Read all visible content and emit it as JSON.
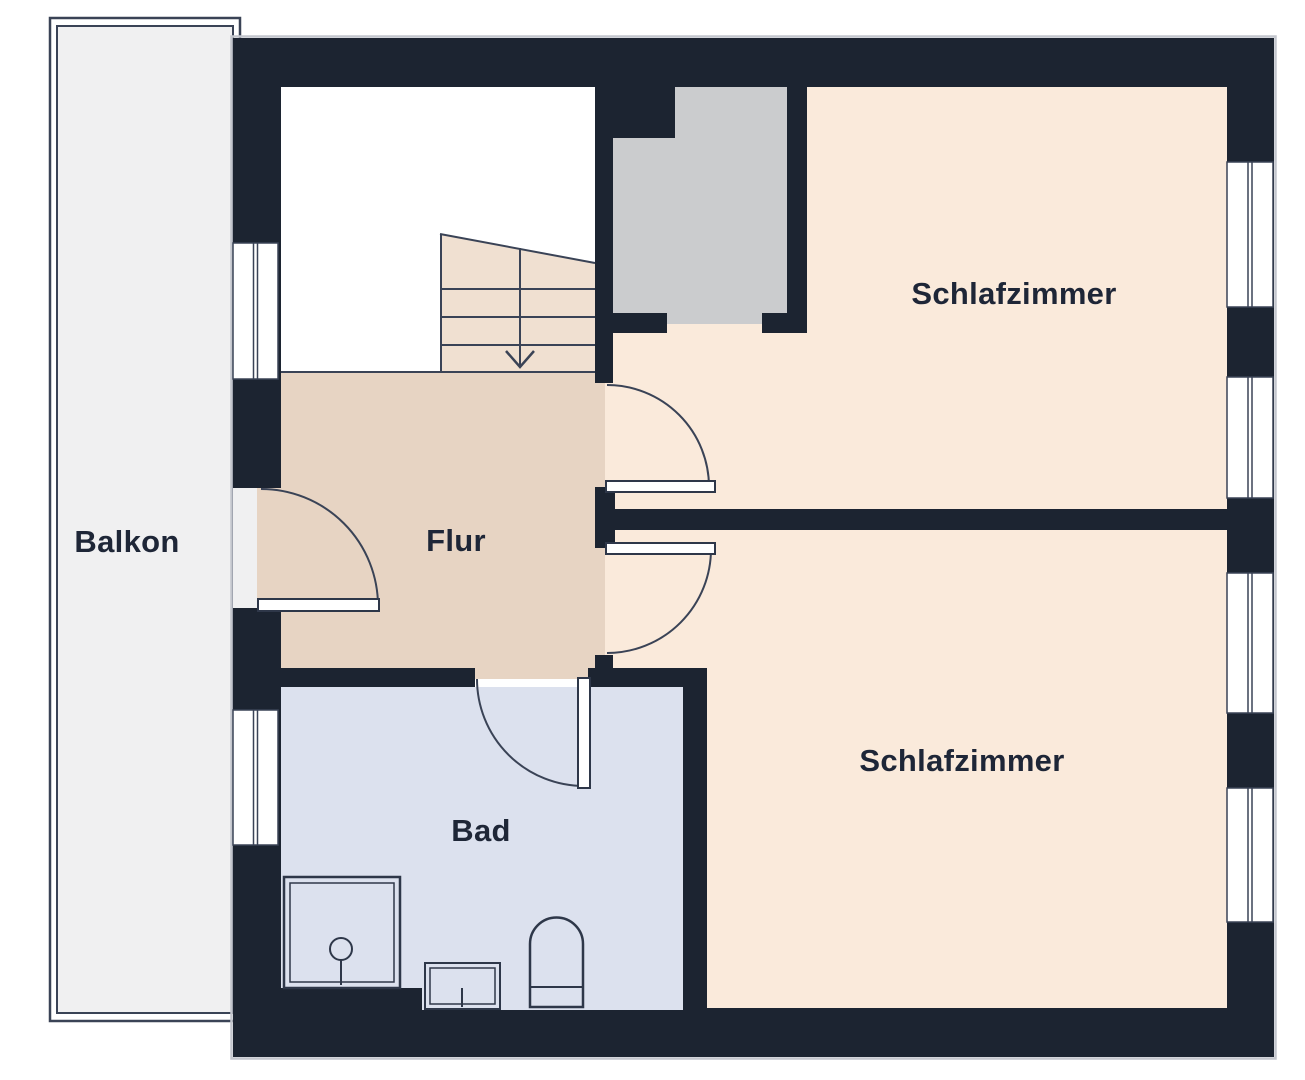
{
  "floorplan": {
    "rooms": [
      {
        "name": "Balkon"
      },
      {
        "name": "Flur"
      },
      {
        "name": "Bad"
      },
      {
        "name": "Schlafzimmer"
      },
      {
        "name": "Schlafzimmer"
      }
    ],
    "colors": {
      "wall": "#1c2431",
      "hallway_floor": "#e7d4c3",
      "bedroom_floor": "#faeadb",
      "bathroom_floor": "#dce1ee",
      "balcony_floor": "#f0f0f1",
      "shaft": "#cbccce",
      "stairs": "#f0e0d1",
      "line": "#3a4356"
    }
  }
}
